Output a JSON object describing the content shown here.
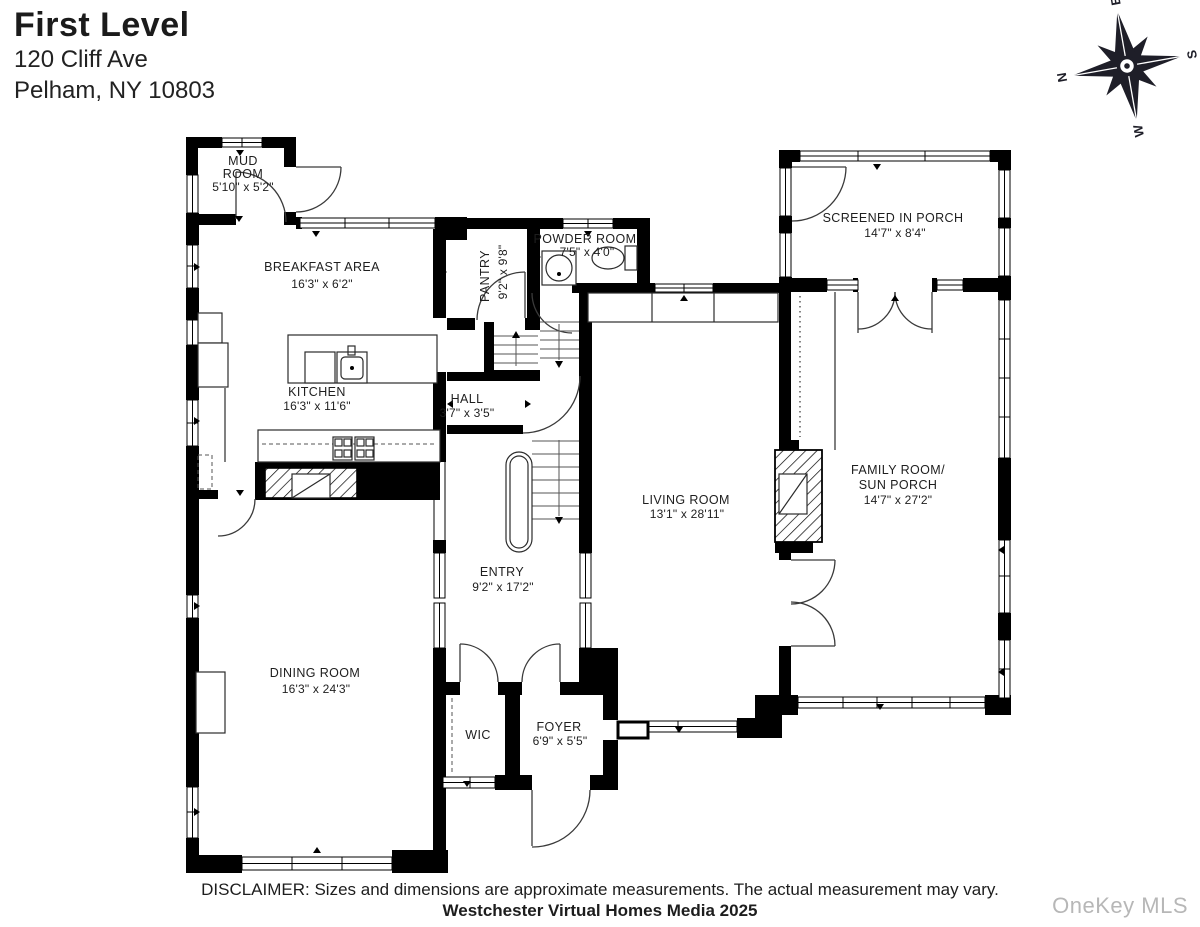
{
  "header": {
    "title": "First Level",
    "address_line1": "120 Cliff Ave",
    "address_line2": "Pelham, NY 10803"
  },
  "compass": {
    "north": "N",
    "east": "E",
    "south": "S",
    "west": "W"
  },
  "rooms": {
    "mud_room": {
      "name_line1": "MUD",
      "name_line2": "ROOM",
      "dims": "5'10\" x 5'2\""
    },
    "breakfast_area": {
      "name": "BREAKFAST AREA",
      "dims": "16'3\" x 6'2\""
    },
    "pantry": {
      "name": "PANTRY",
      "dims": "9'2\" x 9'8\""
    },
    "powder_room": {
      "name": "POWDER ROOM",
      "dims": "7'5\" x 4'0\""
    },
    "screened_porch": {
      "name": "SCREENED IN PORCH",
      "dims": "14'7\" x 8'4\""
    },
    "kitchen": {
      "name": "KITCHEN",
      "dims": "16'3\" x 11'6\""
    },
    "hall": {
      "name": "HALL",
      "dims": "3'7\" x 3'5\""
    },
    "living_room": {
      "name": "LIVING ROOM",
      "dims": "13'1\" x 28'11\""
    },
    "family_room": {
      "name_line1": "FAMILY ROOM/",
      "name_line2": "SUN PORCH",
      "dims": "14'7\" x 27'2\""
    },
    "entry": {
      "name": "ENTRY",
      "dims": "9'2\" x 17'2\""
    },
    "dining_room": {
      "name": "DINING ROOM",
      "dims": "16'3\" x 24'3\""
    },
    "wic": {
      "name": "WIC"
    },
    "foyer": {
      "name": "FOYER",
      "dims": "6'9\" x 5'5\""
    }
  },
  "footer": {
    "disclaimer": "DISCLAIMER: Sizes and dimensions are approximate measurements. The actual measurement may vary.",
    "credit": "Westchester Virtual Homes Media 2025"
  },
  "watermark": "OneKey MLS",
  "colors": {
    "wall": "#000000",
    "label_text": "#1e1e1e",
    "compass": "#1e1e28",
    "watermark": "#b7b7b7"
  }
}
